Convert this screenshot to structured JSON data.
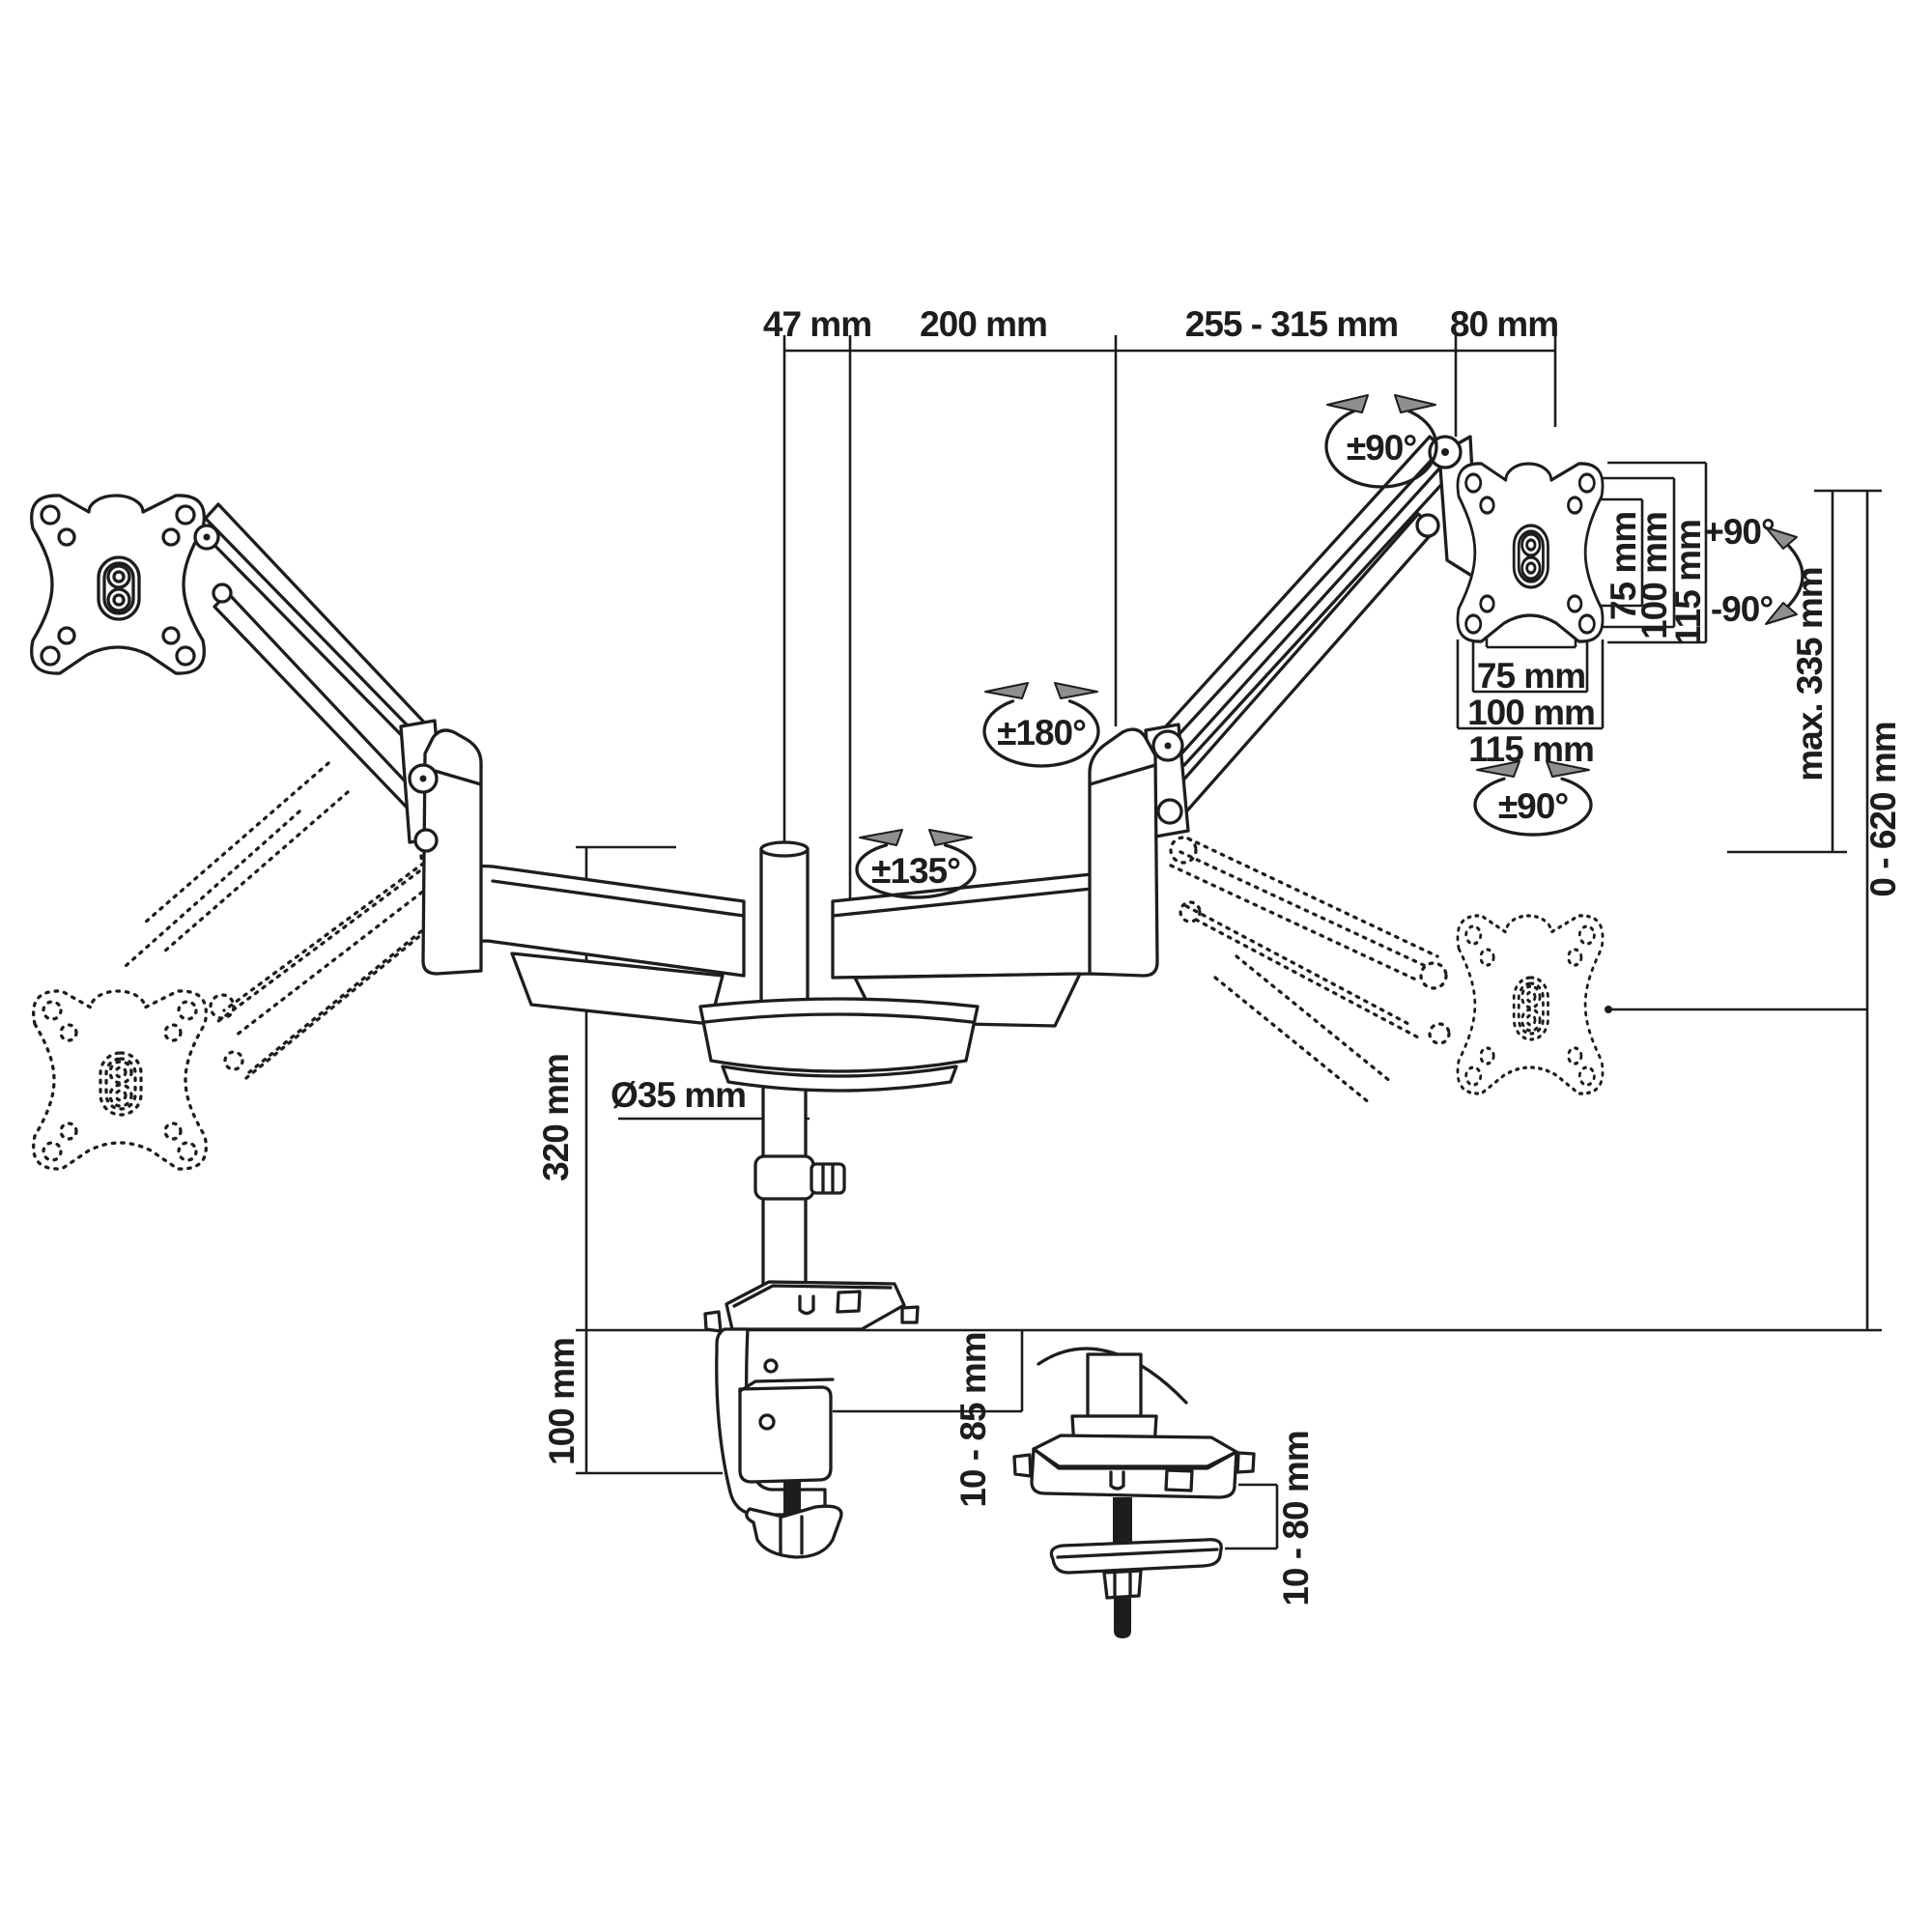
{
  "page": {
    "type": "technical dimension diagram",
    "subject": "dual-arm gas-spring monitor desk mount with clamp and grommet fixing"
  },
  "colors": {
    "ink": "#1d1d1b",
    "arrowhead_fill": "#8f8f8f",
    "background": "#ffffff"
  },
  "labels": {
    "dim_47": "47 mm",
    "dim_200": "200 mm",
    "dim_255_315": "255 - 315 mm",
    "dim_80": "80 mm",
    "rot_top": "±90°",
    "rot_elbow": "±180°",
    "rot_base": "±135°",
    "rot_bottom": "±90°",
    "tilt_up": "+90°",
    "tilt_down": "-90°",
    "vesa_v_75": "75 mm",
    "vesa_v_100": "100 mm",
    "vesa_v_115": "115 mm",
    "vesa_h_75": "75 mm",
    "vesa_h_100": "100 mm",
    "vesa_h_115": "115 mm",
    "lift_range": "max. 335 mm",
    "height_range": "0 - 620 mm",
    "pole_height": "320 mm",
    "pole_diameter": "Ø35 mm",
    "clamp_plate_height": "100 mm",
    "clamp_thickness": "10 - 85 mm",
    "grommet_thickness": "10 - 80 mm"
  }
}
